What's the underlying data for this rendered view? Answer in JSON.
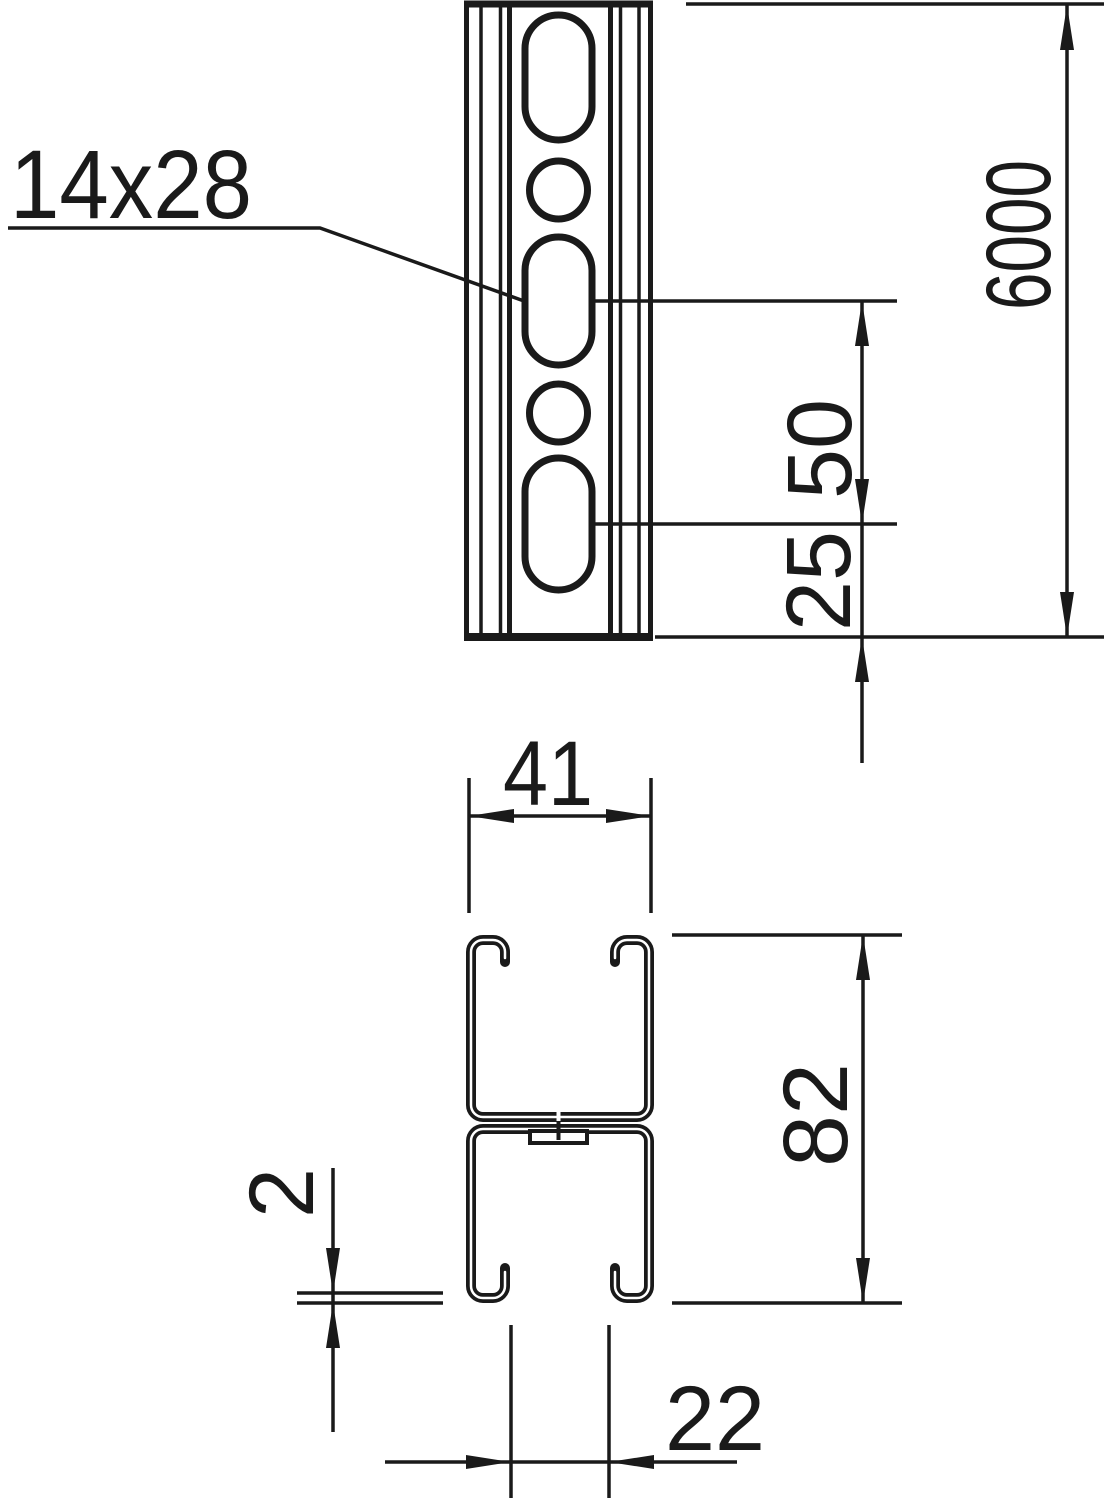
{
  "drawing": {
    "type": "technical-dimension-drawing",
    "subject": "slotted strut profile (double C-channel), front view and cross-section",
    "colors": {
      "line": "#1a1a1a",
      "background": "#ffffff"
    },
    "dimensions": {
      "slot_size": "14x28",
      "profile_length": "6000",
      "slot_pitch": "50",
      "slot_end_distance": "25",
      "profile_width": "41",
      "profile_height": "82",
      "wall_thickness": "2",
      "slot_opening": "22"
    }
  }
}
